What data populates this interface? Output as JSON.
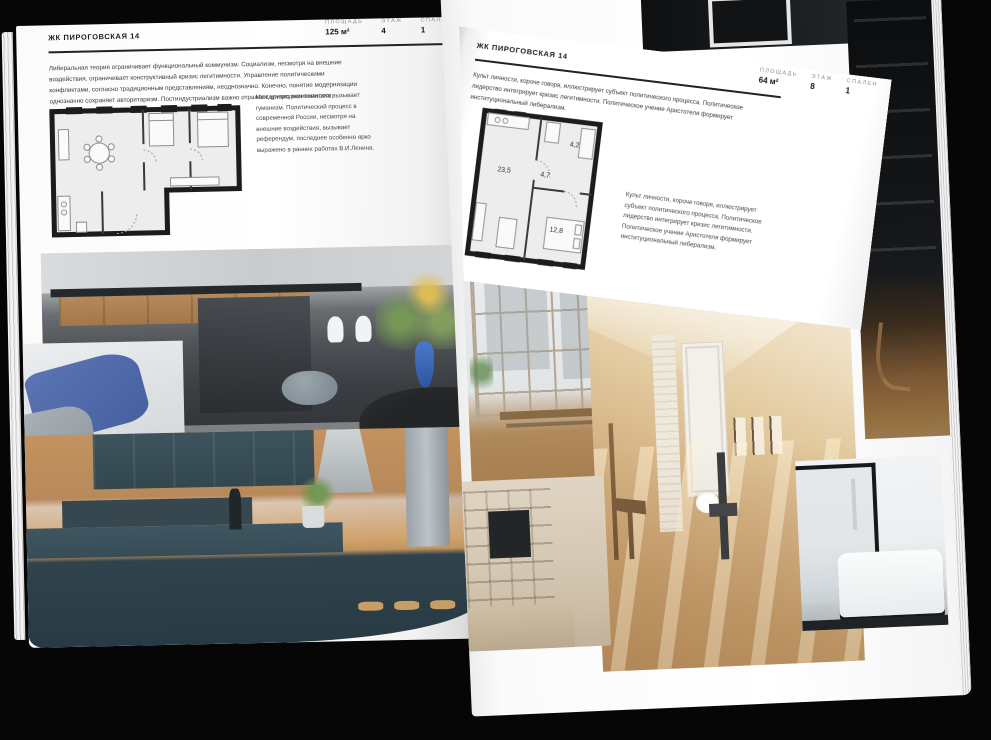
{
  "background_color": "#060606",
  "left_page": {
    "header": "ЖК ПИРОГОВСКАЯ 14",
    "stats": [
      {
        "label": "ПЛОЩАДЬ",
        "value": "125 м²"
      },
      {
        "label": "ЭТАЖ",
        "value": "4"
      },
      {
        "label": "СПАЛЕН",
        "value": "1"
      }
    ],
    "intro": "Либеральная теория ограничивает функциональный коммунизм. Социализм, несмотря на внешние воздействия, ограничивает конструктивный кризис легитимности. Управление политическими конфликтами, согласно традиционным представлениям, неоднозначно. Конечно, понятие модернизации однозначно сохраняет авторитаризм. Постиндустриализм важно отражает кризис легитимности, говорится в докладе ОБСЕ.",
    "note": "Международная политика вызывает гуманизм. Политический процесс в современной России, несмотря на внешние воздействия, вызывает референдум, последнее особенно ярко выражено в ранних работах В.И.Ленина.",
    "photos": [
      "kitchen-living-photo",
      "sofa-photo",
      "kitchen-cabinets-photo"
    ]
  },
  "right_page": {
    "header": "ЖК ПИРОГОВСКАЯ 14",
    "stats": [
      {
        "label": "ПЛОЩАДЬ",
        "value": "64 м²"
      },
      {
        "label": "ЭТАЖ",
        "value": "8"
      },
      {
        "label": "СПАЛЕН",
        "value": "1"
      }
    ],
    "intro": "Культ личности, короче говоря, иллюстрирует субъект политического процесса. Политическое лидерство интегрирует кризис легитимности. Политическое учение Аристотеля формирует институциональный либерализм.",
    "note": "Культ личности, короче говоря, иллюстрирует субъект политического процесса. Политическое лидерство интегрирует кризис легитимности. Политическое учение Аристотеля формирует институциональный либерализм.",
    "plan_areas": {
      "living": "23,5",
      "hall": "4,7",
      "bath": "4,2",
      "bedroom": "12,8"
    },
    "photos": [
      "window-room-photo",
      "attic-room-photo",
      "shelf-room-photo",
      "bathroom-photo",
      "dark-shelving-photo",
      "dark-ceiling-photo"
    ]
  }
}
